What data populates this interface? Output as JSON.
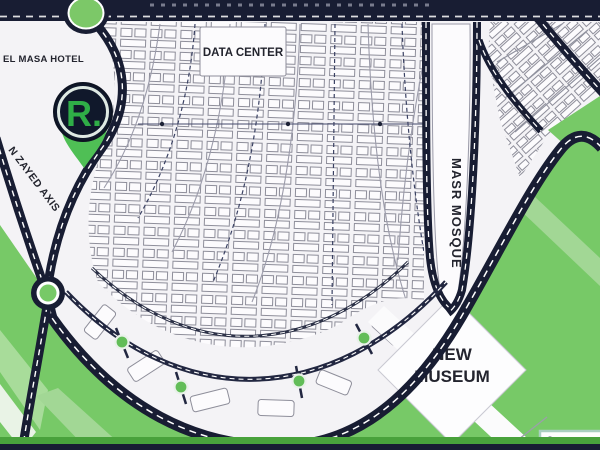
{
  "map": {
    "title": "masterplan-map",
    "labels": {
      "hotel": "EL MASA HOTEL",
      "data_center": "DATA CENTER",
      "mosque": "MASR MOSQUE",
      "museum_line1": "NEW",
      "museum_line2": "MUSEUM",
      "axis": "N ZAYED AXIS",
      "logo": "R."
    },
    "legend": {
      "item": "LRT LIGHT RAIL"
    },
    "colors": {
      "road_navy": "#181d33",
      "map_green": "#77c967",
      "green_light": "#a8dc9a",
      "logo_green": "#2fae47",
      "node_green": "#62bd58",
      "block_outline": "#8e8e9a",
      "legend_border": "#a9cfc0",
      "map_background": "#f4f3f6"
    }
  }
}
